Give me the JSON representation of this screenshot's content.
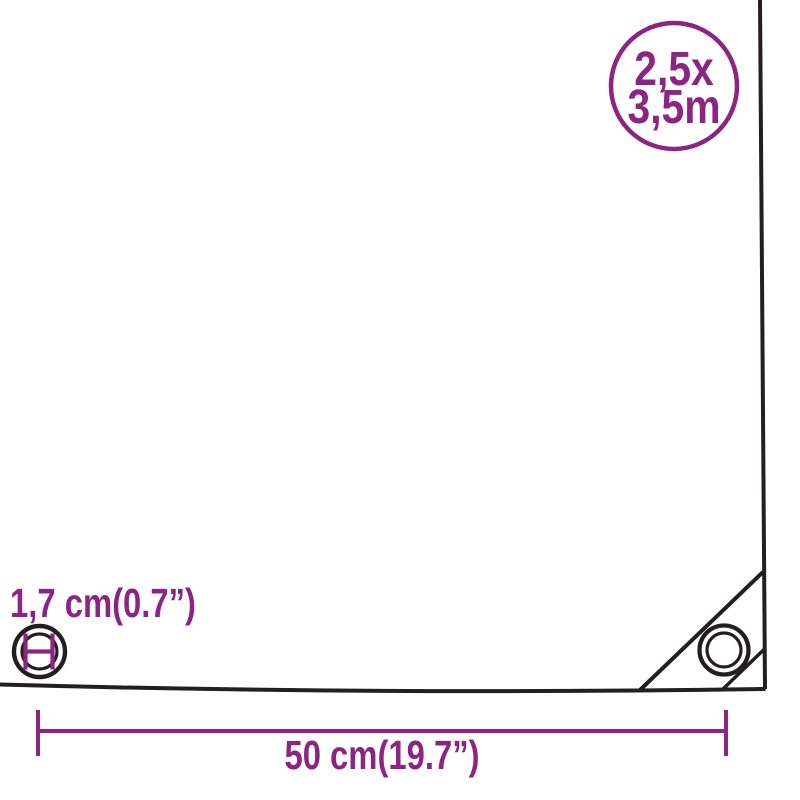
{
  "page": {
    "background": "#FFFFFF"
  },
  "colors": {
    "accent": "#8B2483",
    "line": "#231F20"
  },
  "badge": {
    "line1": "2,5x",
    "line2": "3,5m"
  },
  "labels": {
    "eyelet_diameter": "1,7 cm(0.7”)",
    "edge_distance": "50 cm(19.7”)"
  },
  "icons": {
    "eyelet_diameter_icon": "concentric circles with H diameter mark",
    "corner_eyelet_icon": "concentric circles",
    "size_badge_icon": "circle outline"
  }
}
